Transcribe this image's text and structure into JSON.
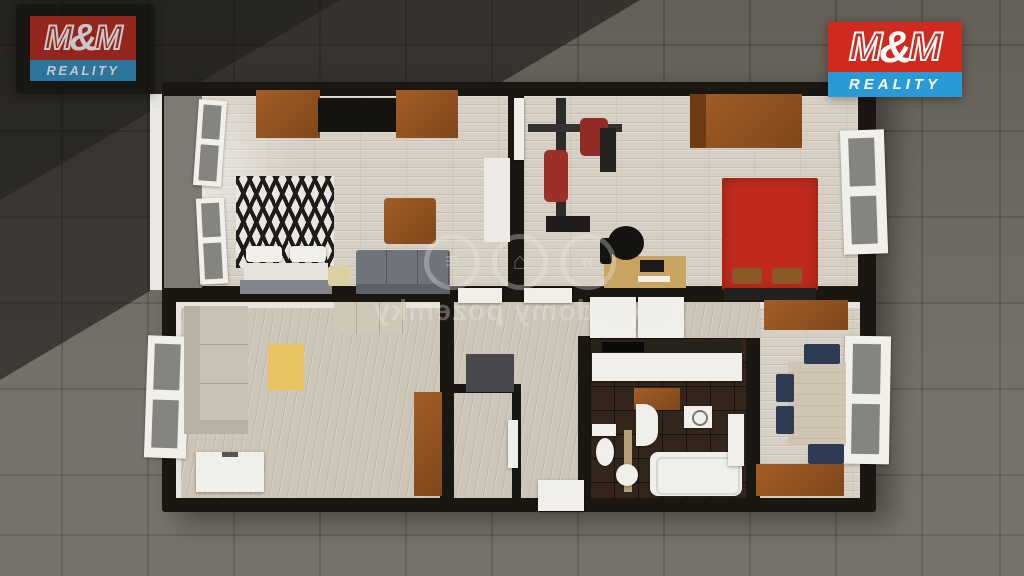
{
  "page": {
    "kind": "3D floor plan render (real-estate listing visual)",
    "width": 1024,
    "height": 576
  },
  "branding": {
    "company": "M&M REALITY",
    "logo": {
      "m_left": "M",
      "ampersand": "&",
      "m_right": "M",
      "reality": "REALITY"
    }
  },
  "watermark": {
    "text": "byty domy pozemky",
    "mirrored": true,
    "icons": [
      "chevrons-icon",
      "house-icon",
      "layers-icon"
    ],
    "icon_glyphs": [
      "»",
      "⌂",
      "≡"
    ]
  },
  "colors": {
    "ground": "#6f6a61",
    "shadow": "rgba(16,14,12,0.55)",
    "wall": "#1a1611",
    "floor_wood": "#d6cfc3",
    "floor_hall": "#cdc5b7",
    "floor_dark": "#35261d",
    "white_fix": "#f0efe9",
    "sofa_gray": "#6f737b",
    "sofa_light": "#c8c2b4",
    "wood_brown": "#a25d25",
    "wood_dark": "#7f471b",
    "bed_red": "#c02a1d",
    "table_yellow": "#e7c45f",
    "chair_navy": "#2d3b55",
    "desk_wood": "#c9a360",
    "gym_red": "#9c2f27",
    "metal_dark": "#2c2b29",
    "watermark": "rgba(238,237,231,0.33)",
    "brand_red": "#d02a1e",
    "brand_blue": "#2a9ad6",
    "logo_white": "#ffffff",
    "balcony": "#7d7973",
    "zebra_dark": "#1d1c1a",
    "zebra_light": "#eae7e0",
    "tan": "#b5a078",
    "cabinet_gray": "#47474c"
  },
  "scene": {
    "ground": "dark concrete tiles with diagonal building shadow (top-left)",
    "rooms": [
      {
        "name": "living-room",
        "position": "top-left",
        "furniture": [
          "wall cabinets",
          "tv console",
          "double bed with zebra throw",
          "white pillows",
          "coffee table",
          "gray sofa",
          "stool",
          "runner rug",
          "open balcony windows"
        ]
      },
      {
        "name": "bedroom-gym",
        "position": "top-right",
        "furniture": [
          "multi-gym machine",
          "wardrobe",
          "red double bed",
          "brown pillows",
          "foot bench",
          "desk",
          "office chair",
          "open window"
        ]
      },
      {
        "name": "bedroom-2",
        "position": "bottom-left",
        "furniture": [
          "light corner sofa",
          "yellow coffee table",
          "daybed",
          "white dresser",
          "brown wardrobe door",
          "open windows"
        ]
      },
      {
        "name": "hallway",
        "position": "bottom-center",
        "furniture": [
          "shoe cabinet",
          "white doorways",
          "closet room"
        ]
      },
      {
        "name": "kitchen",
        "position": "bottom-center-right",
        "furniture": [
          "white countertop",
          "dark counter with cooktop",
          "base cabinet",
          "washing machine"
        ]
      },
      {
        "name": "bathroom-wc",
        "position": "bottom-center-right",
        "furniture": [
          "toilet with cistern",
          "washbasin cabinet",
          "round sink",
          "bathtub",
          "open door"
        ]
      },
      {
        "name": "dining-room",
        "position": "bottom-right",
        "furniture": [
          "dining table",
          "navy chairs",
          "two sideboards",
          "open windows"
        ]
      }
    ]
  }
}
